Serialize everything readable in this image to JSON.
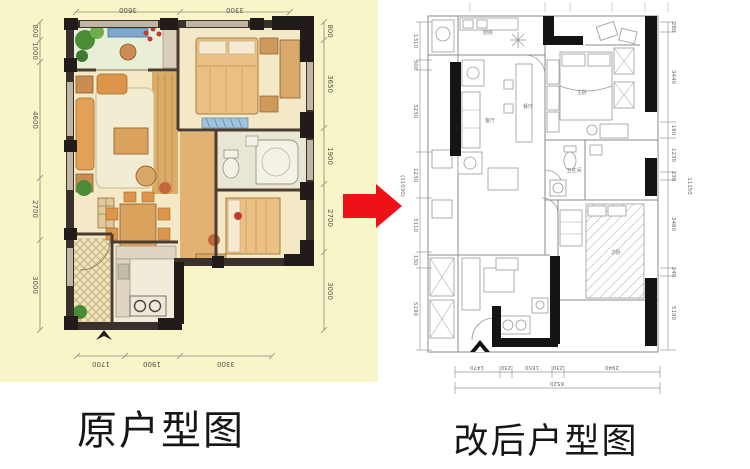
{
  "left_panel": {
    "title": "原户型图",
    "dims": {
      "top": [
        "3600",
        "3300"
      ],
      "bottom": [
        "1700",
        "1900",
        "3300"
      ],
      "left": [
        "800",
        "1000",
        "4600",
        "2700",
        "3000"
      ],
      "right": [
        "800",
        "3650",
        "1900",
        "2700",
        "3000"
      ]
    }
  },
  "right_panel": {
    "title": "改后户型图",
    "dims": {
      "left": [
        "1310",
        "300",
        "3230",
        "1230",
        "3110",
        "130",
        "5190"
      ],
      "left_total": "(11030)",
      "right": [
        "280",
        "3440",
        "180",
        "1230",
        "230",
        "3480",
        "240",
        "5190"
      ],
      "right_total": "11150",
      "bottom": [
        "1470",
        "230",
        "1650",
        "230",
        "2940"
      ],
      "bottom_total": "6520"
    },
    "room_labels": {
      "kitchen": "厨房",
      "living": "客厅",
      "dining": "餐厅",
      "master": "主卧",
      "bath": "卫生间",
      "second": "次卧"
    }
  },
  "arrow": {
    "color": "#ee1118",
    "direction": "right"
  }
}
